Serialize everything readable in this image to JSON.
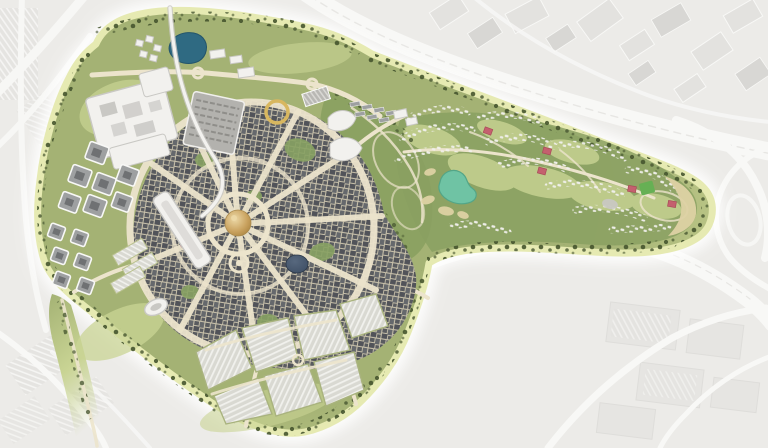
{
  "meta": {
    "title": "Aerial master-plan rendering",
    "description": "Top-down bird's-eye master-plan render of a large expo-style district shown in full colour against a faded white-grey surrounding city. A circular core with a golden central dome and radial streets is flanked by white exhibition halls, grey office clusters, striped parking fans and a golf-course villa community arm extending to the north-east.",
    "view": "aerial render, no text labels or UI chrome visible"
  },
  "regions": {
    "central_dome_plaza": "Golden dome at the centre of a radial street network",
    "core_districts": "Dense petals of grey urban blocks around the central plaza, wrapped by an oval loop road",
    "exhibition_halls": "Large white flat-roofed hall complex, north-west",
    "car_park_deck": "Grey deck structure with parking rows, north of the core",
    "office_campus": "Cluster of square grey office blocks with courtyards, west",
    "rail_station": "White elongated station roof on the west edge of the core",
    "monorail_line": "Pale elevated guideway entering the site from the north",
    "lake": "Small dark teal lake on the northern edge",
    "observation_ring": "Golden ring structure north-east of the dome",
    "arena": "White oval venue on the south-west loop road",
    "navy_dome": "Dark blue-grey dome south-east of the centre",
    "pink_dome": "Small pink dome west of the centre",
    "event_park": "Olive park with winding paths, white leaf-shaped lots and stall rows east of the core",
    "golf_community": "Golf-course arm with curved villa rows, teal pond, sand bunkers, bright green field and pink clubhouses",
    "south_parking": "Fan of striped surface parking fields along the southern edge",
    "west_parking": "Small striped parking strips on the west side",
    "perimeter_landscape": "Yellow-green landscaped buffer with dark tree lines around the whole site",
    "context_city": "Faded white-grey industrial blocks and parking grids surrounding the site",
    "highway_north": "Motorway running diagonally above the golf arm",
    "highway_south": "Motorway wrapping below the golf arm with interchange ramps to the east"
  },
  "colors": {
    "ctx_bg": "#ecebe8",
    "ctx_road": "#f8f8f6",
    "ctx_block": "#e3e2df",
    "ctx_block_dark": "#d8d7d4",
    "glow": "#ffffff",
    "site_edge": "#e6eab2",
    "site_green": "#a4b274",
    "site_green_light": "#c9d292",
    "park_olive": "#8aa061",
    "lawn": "#c9d494",
    "tree_dark": "#46552f",
    "street": "#ece4cc",
    "city_street": "#c7c0aa",
    "block_dark": "#595b5f",
    "block_mid": "#65686c",
    "block_dark2": "#515359",
    "dome_gold": "#c9a25f",
    "dome_gold_light": "#ecd8a6",
    "gold_ring": "#d8b75f",
    "navy_dome": "#3c4c62",
    "pink_dome": "#c98f9b",
    "pink_villa": "#c4606e",
    "white_bldg": "#f2f1ee",
    "bldg_shadow": "#c9c8c4",
    "office_gray": "#9ea0a1",
    "office_core": "#6f7173",
    "deck_gray": "#b3b2ae",
    "deck_row": "#8f8e8a",
    "lake_blue": "#2f6a82",
    "pond_teal": "#6fc3a4",
    "sand": "#ded2a4",
    "parking": "#d9d9d2",
    "parking_stripe": "#f1f1ed",
    "panel_gray": "#b9b8b4",
    "panel_stripe": "#d9d8d4",
    "field_green": "#66b054",
    "rail_white": "#f3f2ef",
    "pocket_green": "#88a263"
  }
}
